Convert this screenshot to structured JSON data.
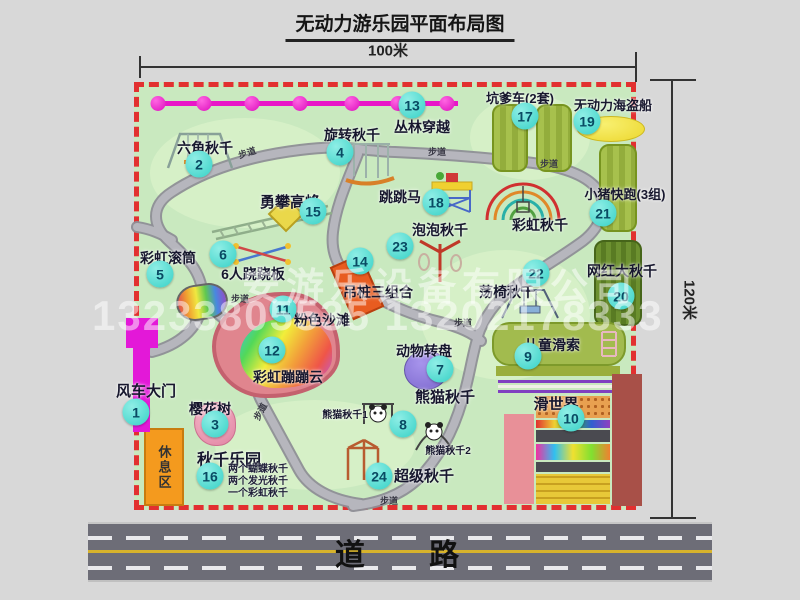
{
  "title": "无动力游乐园平面布局图",
  "dims": {
    "width": "100米",
    "height": "120米"
  },
  "road": {
    "label": "道 路"
  },
  "watermark": {
    "company": "安游乐设备有限公司",
    "phone": "13233805535 13202178333"
  },
  "rest_area": "休息区",
  "trail_label": "步道",
  "colors": {
    "map_green": "#c9e9bf",
    "border_red": "#e23030",
    "badge_teal": "#37d1c6",
    "chain_magenta": "#e816c8",
    "rest_orange": "#f49a1e",
    "road_gray": "#6d6d77"
  },
  "attractions": [
    {
      "num": "1",
      "label": "风车大门"
    },
    {
      "num": "2",
      "label": "六角秋千"
    },
    {
      "num": "3",
      "label": "樱花树"
    },
    {
      "num": "4",
      "label": "旋转秋千"
    },
    {
      "num": "5",
      "label": "彩虹滚筒"
    },
    {
      "num": "6",
      "label": "6人跷跷板"
    },
    {
      "num": "7",
      "label": "动物转盘"
    },
    {
      "num": "8",
      "label": "熊猫秋千"
    },
    {
      "num": "9",
      "label": "儿童滑索"
    },
    {
      "num": "10",
      "label": "滑世界"
    },
    {
      "num": "11",
      "label": "粉色沙滩"
    },
    {
      "num": "12",
      "label": "彩虹蹦蹦云"
    },
    {
      "num": "13",
      "label": "丛林穿越"
    },
    {
      "num": "14",
      "label": "吊桩三组合"
    },
    {
      "num": "15",
      "label": "勇攀高峰"
    },
    {
      "num": "16",
      "label": "秋千乐园"
    },
    {
      "num": "17",
      "label": "坑爹车(2套)"
    },
    {
      "num": "18",
      "label": "跳跳马"
    },
    {
      "num": "19",
      "label": "无动力海盗船"
    },
    {
      "num": "20",
      "label": "网红大秋千"
    },
    {
      "num": "21",
      "label": "小猪快跑(3组)"
    },
    {
      "num": "22",
      "label": "荡椅秋千"
    },
    {
      "num": "23",
      "label": "泡泡秋千"
    },
    {
      "num": "24",
      "label": "超级秋千"
    }
  ],
  "extra_labels": {
    "rainbow_swing": "彩虹秋千",
    "panda1": "熊猫秋千1",
    "panda2": "熊猫秋千2",
    "swing_park_notes": [
      "两个蝴蝶秋千",
      "两个发光秋千",
      "一个彩虹秋千"
    ]
  }
}
